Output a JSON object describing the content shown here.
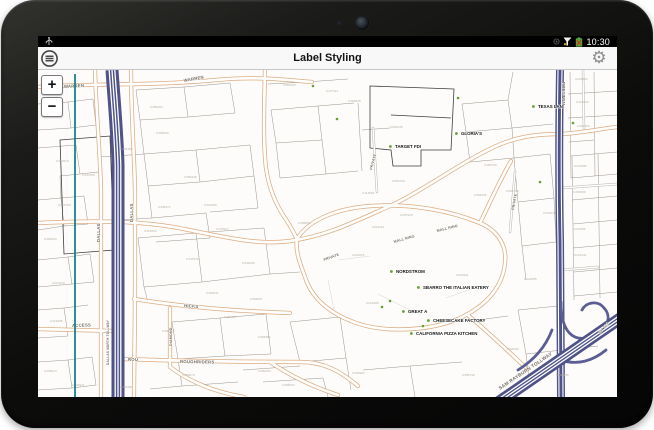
{
  "status_bar": {
    "time": "10:30",
    "icons": [
      "usb-icon",
      "notification-dim-icon",
      "signal-warning-icon",
      "battery-warning-icon"
    ]
  },
  "app_bar": {
    "title": "Label Styling",
    "menu_icon": "menu",
    "settings_icon": "settings"
  },
  "map": {
    "zoom_in_label": "+",
    "zoom_out_label": "−",
    "colors": {
      "road_casing": "#dcab80",
      "highway": "#52568c",
      "poi_marker": "#63a035",
      "parcel_line": "#9a948c",
      "parcel_label": "#b9afa4",
      "road_label": "#766d62"
    },
    "road_labels": [
      {
        "t": "WARREN",
        "x": 26,
        "y": 18,
        "r": -3
      },
      {
        "t": "WARREN",
        "x": 146,
        "y": 12,
        "r": -10
      },
      {
        "t": "DALLAS",
        "x": 62,
        "y": 172,
        "r": -90
      },
      {
        "t": "DALLAS",
        "x": 95,
        "y": 152,
        "r": -90
      },
      {
        "t": "DALLAS NORTH TOLLWAY",
        "x": 71,
        "y": 295,
        "r": -90,
        "s": 3.2
      },
      {
        "t": "PRESTON",
        "x": 524,
        "y": 12,
        "r": 90,
        "s": 4.5
      },
      {
        "t": "MALL RING",
        "x": 356,
        "y": 173,
        "r": -16,
        "s": 3.6
      },
      {
        "t": "MALL RING",
        "x": 399,
        "y": 162,
        "r": -14,
        "s": 3.6
      },
      {
        "t": "PRIVATE",
        "x": 334,
        "y": 100,
        "r": -75,
        "s": 3.6
      },
      {
        "t": "PRIVATE",
        "x": 476,
        "y": 140,
        "r": -80,
        "s": 3.6
      },
      {
        "t": "PRIVATE",
        "x": 286,
        "y": 191,
        "r": -20,
        "s": 3.6
      },
      {
        "t": "HICKS",
        "x": 146,
        "y": 237,
        "r": 4
      },
      {
        "t": "DIAMOND",
        "x": 134,
        "y": 276,
        "r": -90,
        "s": 3.6
      },
      {
        "t": "ROUGHRIDERS",
        "x": 142,
        "y": 293,
        "r": 1
      },
      {
        "t": "ROU",
        "x": 90,
        "y": 291
      },
      {
        "t": "ACCESS",
        "x": 34,
        "y": 257,
        "r": -2
      },
      {
        "t": "SAM RAYBURN TOLLWAY",
        "x": 462,
        "y": 320,
        "r": -34,
        "s": 4.8
      },
      {
        "t": "SH 121",
        "x": 562,
        "y": 264,
        "r": -48,
        "s": 3.8
      }
    ],
    "poi_labels": [
      {
        "t": "TARGET FDI",
        "x": 357,
        "y": 78
      },
      {
        "t": "GLORIA'S",
        "x": 423,
        "y": 65
      },
      {
        "t": "TEXAS LAN",
        "x": 500,
        "y": 38
      },
      {
        "t": "NORDSTROM",
        "x": 358,
        "y": 203
      },
      {
        "t": "SBARRO THE ITALIAN EATERY",
        "x": 385,
        "y": 219
      },
      {
        "t": "GREAT A",
        "x": 370,
        "y": 243
      },
      {
        "t": "CHEESECAKE FACTORY",
        "x": 395,
        "y": 252
      },
      {
        "t": "CALIFORNIA PIZZA KITCHEN",
        "x": 378,
        "y": 265
      }
    ],
    "poi_markers": [
      {
        "x": 275,
        "y": 16
      },
      {
        "x": 299,
        "y": 49
      },
      {
        "x": 420,
        "y": 28
      },
      {
        "x": 535,
        "y": 53
      },
      {
        "x": 502,
        "y": 112
      },
      {
        "x": 344,
        "y": 237
      },
      {
        "x": 352,
        "y": 231
      },
      {
        "x": 385,
        "y": 256
      }
    ],
    "parcel_labels": [
      {
        "t": "C368197",
        "x": 12,
        "y": 47
      },
      {
        "t": "C363679",
        "x": 18,
        "y": 92
      },
      {
        "t": "C363750",
        "x": 20,
        "y": 136
      },
      {
        "t": "C364004",
        "x": 6,
        "y": 170
      },
      {
        "t": "C210470",
        "x": 14,
        "y": 214
      },
      {
        "t": "C213305",
        "x": 12,
        "y": 252
      },
      {
        "t": "C303973",
        "x": 6,
        "y": 302
      },
      {
        "t": "C303971",
        "x": 34,
        "y": 316
      },
      {
        "t": "C356493",
        "x": 112,
        "y": 38
      },
      {
        "t": "C363829",
        "x": 118,
        "y": 64
      },
      {
        "t": "C364780",
        "x": 82,
        "y": 80
      },
      {
        "t": "C347388",
        "x": 44,
        "y": 106
      },
      {
        "t": "C358448",
        "x": 146,
        "y": 108
      },
      {
        "t": "C356471",
        "x": 120,
        "y": 138
      },
      {
        "t": "C313263",
        "x": 106,
        "y": 162
      },
      {
        "t": "C313283",
        "x": 166,
        "y": 136
      },
      {
        "t": "C347517",
        "x": 178,
        "y": 160
      },
      {
        "t": "C347516",
        "x": 148,
        "y": 190
      },
      {
        "t": "C344069",
        "x": 204,
        "y": 194
      },
      {
        "t": "C363441",
        "x": 168,
        "y": 224
      },
      {
        "t": "C364007",
        "x": 212,
        "y": 230
      },
      {
        "t": "C360671",
        "x": 124,
        "y": 262
      },
      {
        "t": "C254007",
        "x": 186,
        "y": 248
      },
      {
        "t": "C364561",
        "x": 220,
        "y": 268
      },
      {
        "t": "C366070",
        "x": 144,
        "y": 306
      },
      {
        "t": "C360204",
        "x": 220,
        "y": 302
      },
      {
        "t": "C190480",
        "x": 82,
        "y": 318
      },
      {
        "t": "C368094",
        "x": 244,
        "y": 316
      },
      {
        "t": "C332983",
        "x": 314,
        "y": 304
      },
      {
        "t": "C358749",
        "x": 424,
        "y": 306
      },
      {
        "t": "C363204",
        "x": 245,
        "y": 16
      },
      {
        "t": "C377111",
        "x": 288,
        "y": 22
      },
      {
        "t": "C363828",
        "x": 310,
        "y": 32
      },
      {
        "t": "C091238",
        "x": 352,
        "y": 58
      },
      {
        "t": "C091230",
        "x": 354,
        "y": 112
      },
      {
        "t": "C113964",
        "x": 324,
        "y": 124
      },
      {
        "t": "C454436",
        "x": 436,
        "y": 126
      },
      {
        "t": "C091113",
        "x": 334,
        "y": 158
      },
      {
        "t": "C211974",
        "x": 314,
        "y": 186
      },
      {
        "t": "C356064",
        "x": 260,
        "y": 154
      },
      {
        "t": "C337915",
        "x": 362,
        "y": 146
      },
      {
        "t": "C213941",
        "x": 418,
        "y": 206
      },
      {
        "t": "C212989",
        "x": 328,
        "y": 234
      },
      {
        "t": "C214605",
        "x": 486,
        "y": 210
      },
      {
        "t": "C216200",
        "x": 468,
        "y": 280
      },
      {
        "t": "C163195",
        "x": 518,
        "y": 306
      },
      {
        "t": "C380763",
        "x": 446,
        "y": 96
      },
      {
        "t": "C394766",
        "x": 468,
        "y": 122
      },
      {
        "t": "C218802",
        "x": 537,
        "y": 10
      },
      {
        "t": "C214802",
        "x": 538,
        "y": 33
      },
      {
        "t": "C214852",
        "x": 539,
        "y": 57
      },
      {
        "t": "C211508",
        "x": 536,
        "y": 97
      },
      {
        "t": "C215009",
        "x": 535,
        "y": 123
      },
      {
        "t": "C313070",
        "x": 505,
        "y": 144
      },
      {
        "t": "C211509",
        "x": 535,
        "y": 160
      },
      {
        "t": "C213141",
        "x": 536,
        "y": 186
      }
    ]
  }
}
